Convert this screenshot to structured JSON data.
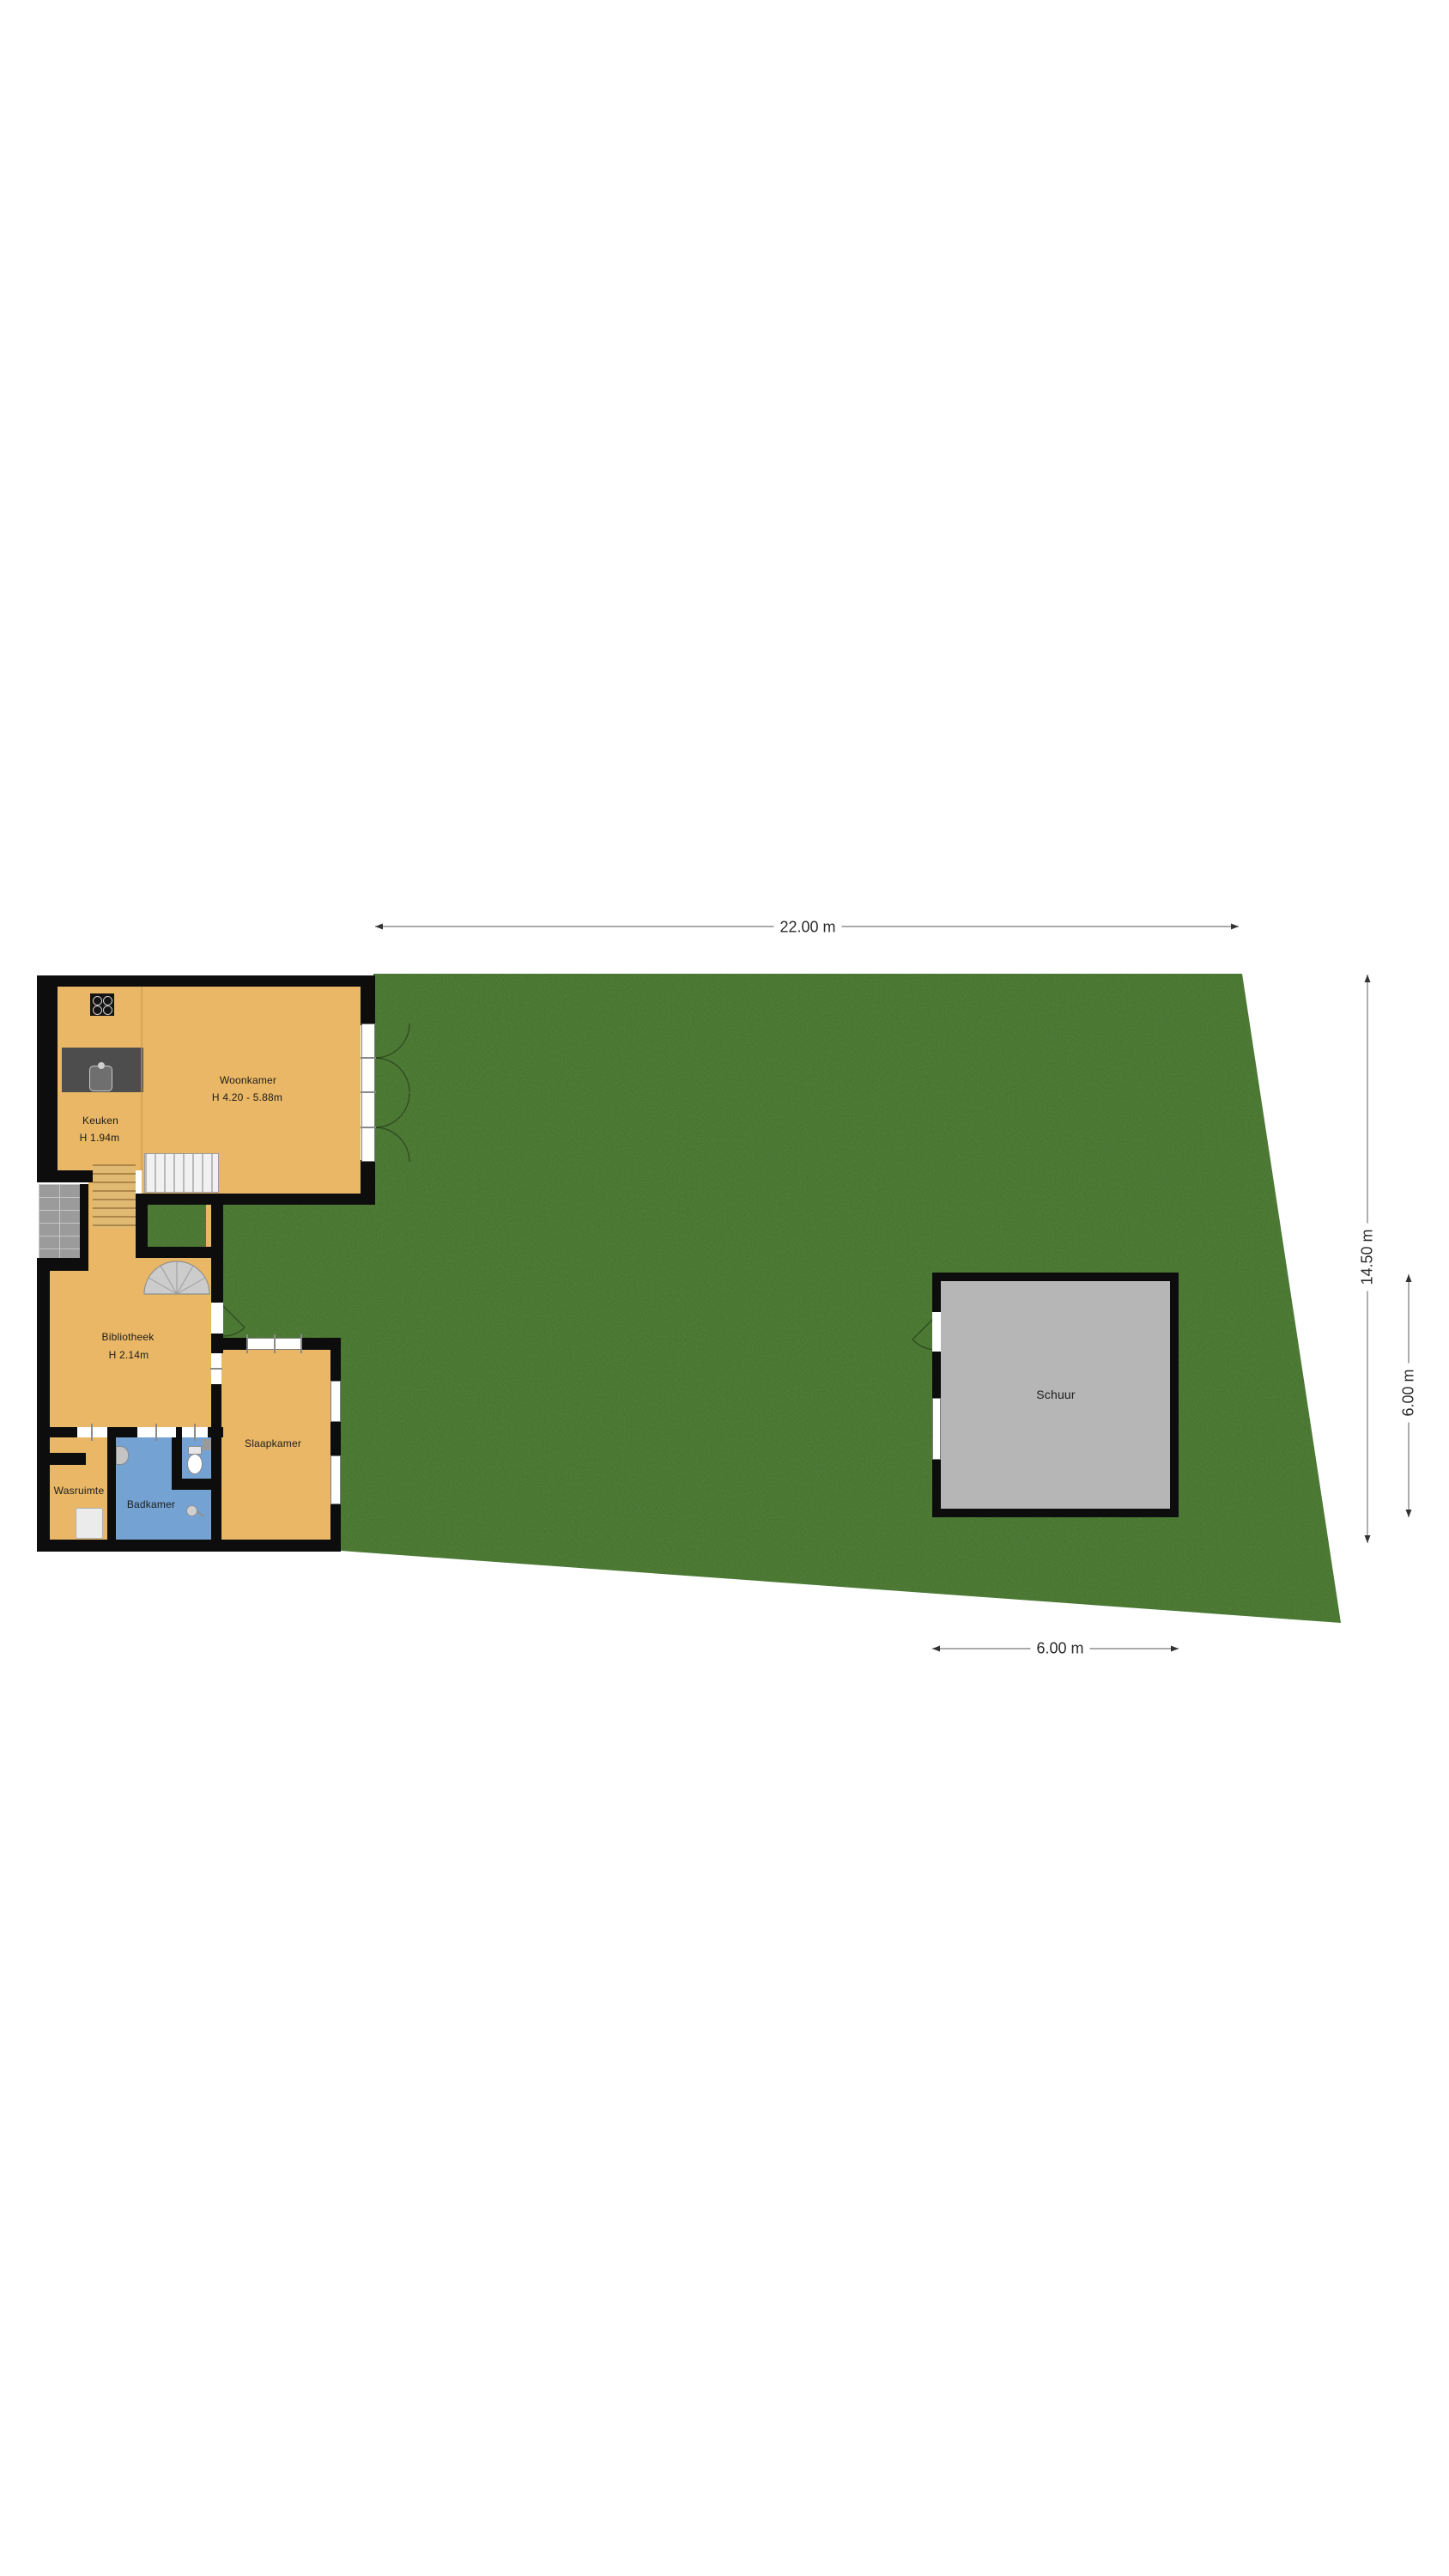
{
  "plan_type": "floorplan-with-garden",
  "rooms": {
    "keuken": {
      "name": "Keuken",
      "height": "H 1.94m"
    },
    "woonkamer": {
      "name": "Woonkamer",
      "height": "H 4.20 - 5.88m"
    },
    "bibliotheek": {
      "name": "Bibliotheek",
      "height": "H 2.14m"
    },
    "wasruimte": {
      "name": "Wasruimte"
    },
    "badkamer": {
      "name": "Badkamer"
    },
    "slaapkamer": {
      "name": "Slaapkamer"
    },
    "schuur": {
      "name": "Schuur"
    }
  },
  "dimensions": {
    "plot_width": "22.00 m",
    "plot_depth": "14.50 m",
    "schuur_depth": "6.00 m",
    "schuur_width": "6.00 m"
  },
  "colors": {
    "floor_tan": "#e9b765",
    "garden_green": "#55853a",
    "bathroom_blue": "#74a2d2",
    "shed_gray": "#b6b6b6",
    "wall_black": "#0d0d0d",
    "patio_gray": "#9b9b9b",
    "dim_line": "#777777"
  }
}
